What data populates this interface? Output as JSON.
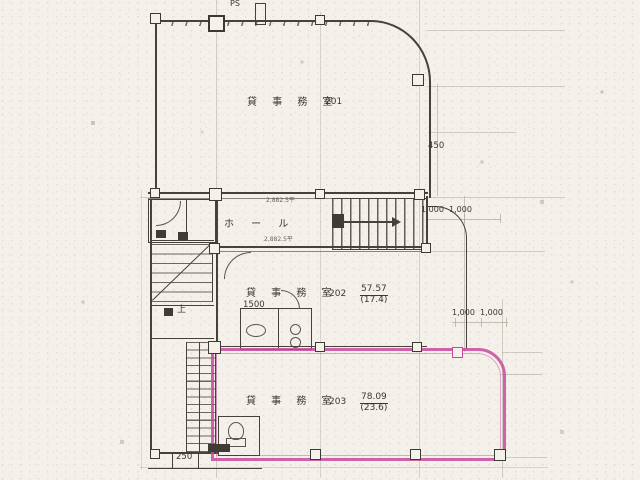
{
  "plan_type": "floor-plan-scan",
  "colors": {
    "highlight": "#c8499c",
    "ink": "#45423c",
    "paper": "#f3f1ea",
    "faint": "#b9b5a9"
  },
  "rooms": {
    "r201": {
      "name": "貸 事 務 室",
      "number": "201"
    },
    "r202": {
      "name": "貸 事 務 室",
      "number": "202",
      "area_m2": "57.57",
      "area_tsubo": "(17.4)"
    },
    "r203": {
      "name": "貸 事 務 室",
      "number": "203",
      "area_m2": "78.09",
      "area_tsubo": "(23.6)"
    }
  },
  "labels": {
    "hall": "ホ ー ル",
    "pipe_shaft": "PS",
    "up": "上"
  },
  "dimensions": {
    "v450": "450",
    "top1000_l": "1,000",
    "top1000_r": "1,000",
    "mid1000_l": "1,000",
    "mid1000_r": "1,000",
    "w1500": "1500",
    "w250": "250",
    "note_upper": "2,882.5平",
    "note_lower": "2,882.5平"
  }
}
